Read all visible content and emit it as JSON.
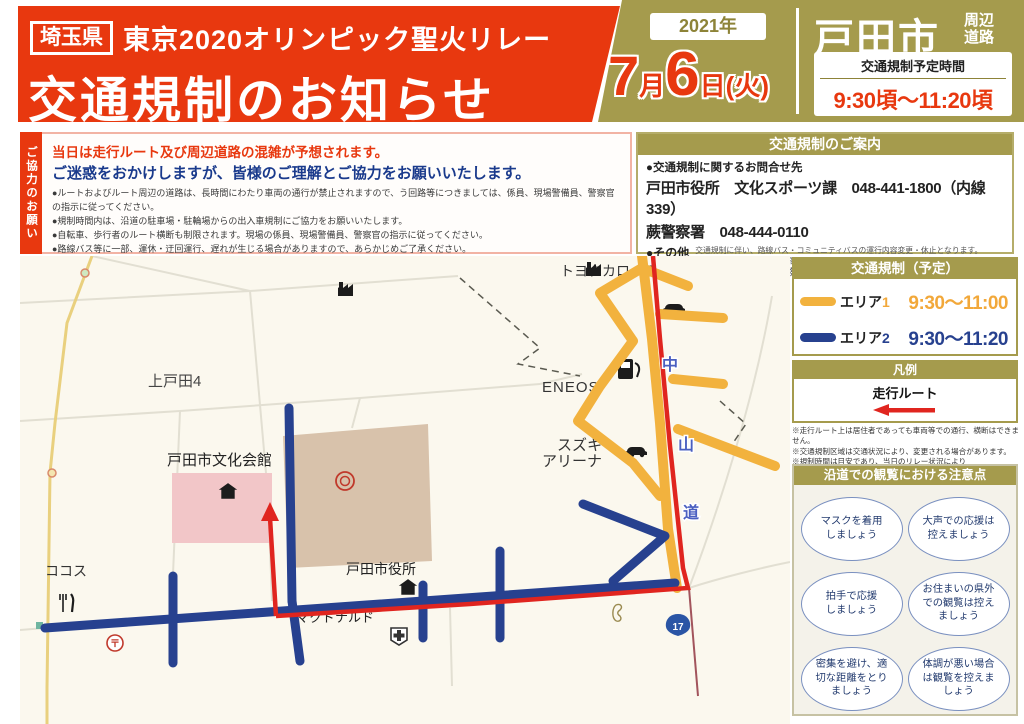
{
  "header": {
    "prefecture_badge": "埼玉県",
    "relay_title": "東京2020オリンピック聖火リレー",
    "main_title": "交通規制のお知らせ",
    "year": "2021年",
    "date": {
      "month_num": "7",
      "month_label": "月",
      "day_num": "6",
      "day_label": "日(火)"
    },
    "city": "戸田市",
    "roads_line1": "周辺",
    "roads_line2": "道路",
    "time_box_title": "交通規制予定時間",
    "time_box_value": "9:30頃～11:20頃"
  },
  "request": {
    "tab": "ご協力のお願い",
    "headline_red": "当日は走行ルート及び周辺道路の混雑が予想されます。",
    "headline_blue": "ご迷惑をおかけしますが、皆様のご理解とご協力をお願いいたします。",
    "bullets": [
      "●ルートおよびルート周辺の道路は、長時間にわたり車両の通行が禁止されますので、う回路等につきましては、係員、現場警備員、警察官の指示に従ってください。",
      "●規制時間内は、沿道の駐車場・駐輪場からの出入車規制にご協力をお願いいたします。",
      "●自転車、歩行者のルート横断も制限されます。現場の係員、現場警備員、警察官の指示に従ってください。",
      "●路線バス等に一部、運休・迂回運行、遅れが生じる場合がありますので、あらかじめご了承ください。",
      "●航空法に基づき、許可等を得ずにルート及び、周辺で無人航空機(ドローン)を飛行させることはできません。"
    ]
  },
  "guide": {
    "title": "交通規制のご案内",
    "contact_heading": "●交通規制に関するお問合せ先",
    "contact_line1": "戸田市役所　文化スポーツ課　048-441-1800（内線339）",
    "contact_line2": "蕨警察署　048-444-0110",
    "other_label": "●その他",
    "other_note1": "交通規制に伴い、路線バス・コミュニティバスの運行内容変更・休止となります。",
    "other_note2": "運行に関しては、下記にお問い合わせください。",
    "bus_line1": "路線バス　　：国際興業（株）戸田営業所　048-421-1411",
    "bus_line2": "コミュニティバス：戸田市役所　都市交通課　048-441-1800（内線263）"
  },
  "regulation_panel": {
    "title": "交通規制（予定）",
    "areas": [
      {
        "label_text": "エリア",
        "label_num": "1",
        "time": "9:30～11:00",
        "color": "#f2a83a"
      },
      {
        "label_text": "エリア",
        "label_num": "2",
        "time": "9:30～11:20",
        "color": "#27418f"
      }
    ]
  },
  "legend_panel": {
    "title": "凡例",
    "route_label": "走行ルート",
    "notes": [
      "※走行ルート上は居住者であっても車両等での通行、横断はできません。",
      "※交通規制区域は交通状況により、変更される場合があります。",
      "※規制時間は目安であり、当日のリレー状況により",
      "　変更される場合があります。"
    ]
  },
  "tips_panel": {
    "title": "沿道での観覧における注意点",
    "tips": [
      {
        "line1": "マスクを着用",
        "line2": "しましょう",
        "line3": ""
      },
      {
        "line1": "大声での応援は",
        "line2": "控えましょう",
        "line3": ""
      },
      {
        "line1": "拍手で応援",
        "line2": "しましょう",
        "line3": ""
      },
      {
        "line1": "お住まいの県外",
        "line2": "での観覧は控え",
        "line3": "ましょう"
      },
      {
        "line1": "密集を避け、適",
        "line2": "切な距離をとり",
        "line3": "ましょう"
      },
      {
        "line1": "体調が悪い場合",
        "line2": "は観覧を控えま",
        "line3": "しょう"
      }
    ]
  },
  "map": {
    "labels": {
      "kamitoda": "上戸田4",
      "bunka_kaikan": "戸田市文化会館",
      "eneos": "ENEOS",
      "corolla": "トヨタカローラ",
      "suzuki1": "スズキ",
      "suzuki2": "アリーナ",
      "nakasendo1": "中",
      "nakasendo2": "山",
      "nakasendo3": "道",
      "cocos": "ココス",
      "city_hall": "戸田市役所",
      "mcdonalds": "マクドナルド",
      "route17": "17",
      "post_mark": "〒"
    }
  },
  "colors": {
    "banner_red": "#e8380f",
    "olive_gold": "#a59b4d",
    "route_red": "#e0251f",
    "area1_orange": "#f2b23e",
    "area2_blue": "#27418f"
  }
}
